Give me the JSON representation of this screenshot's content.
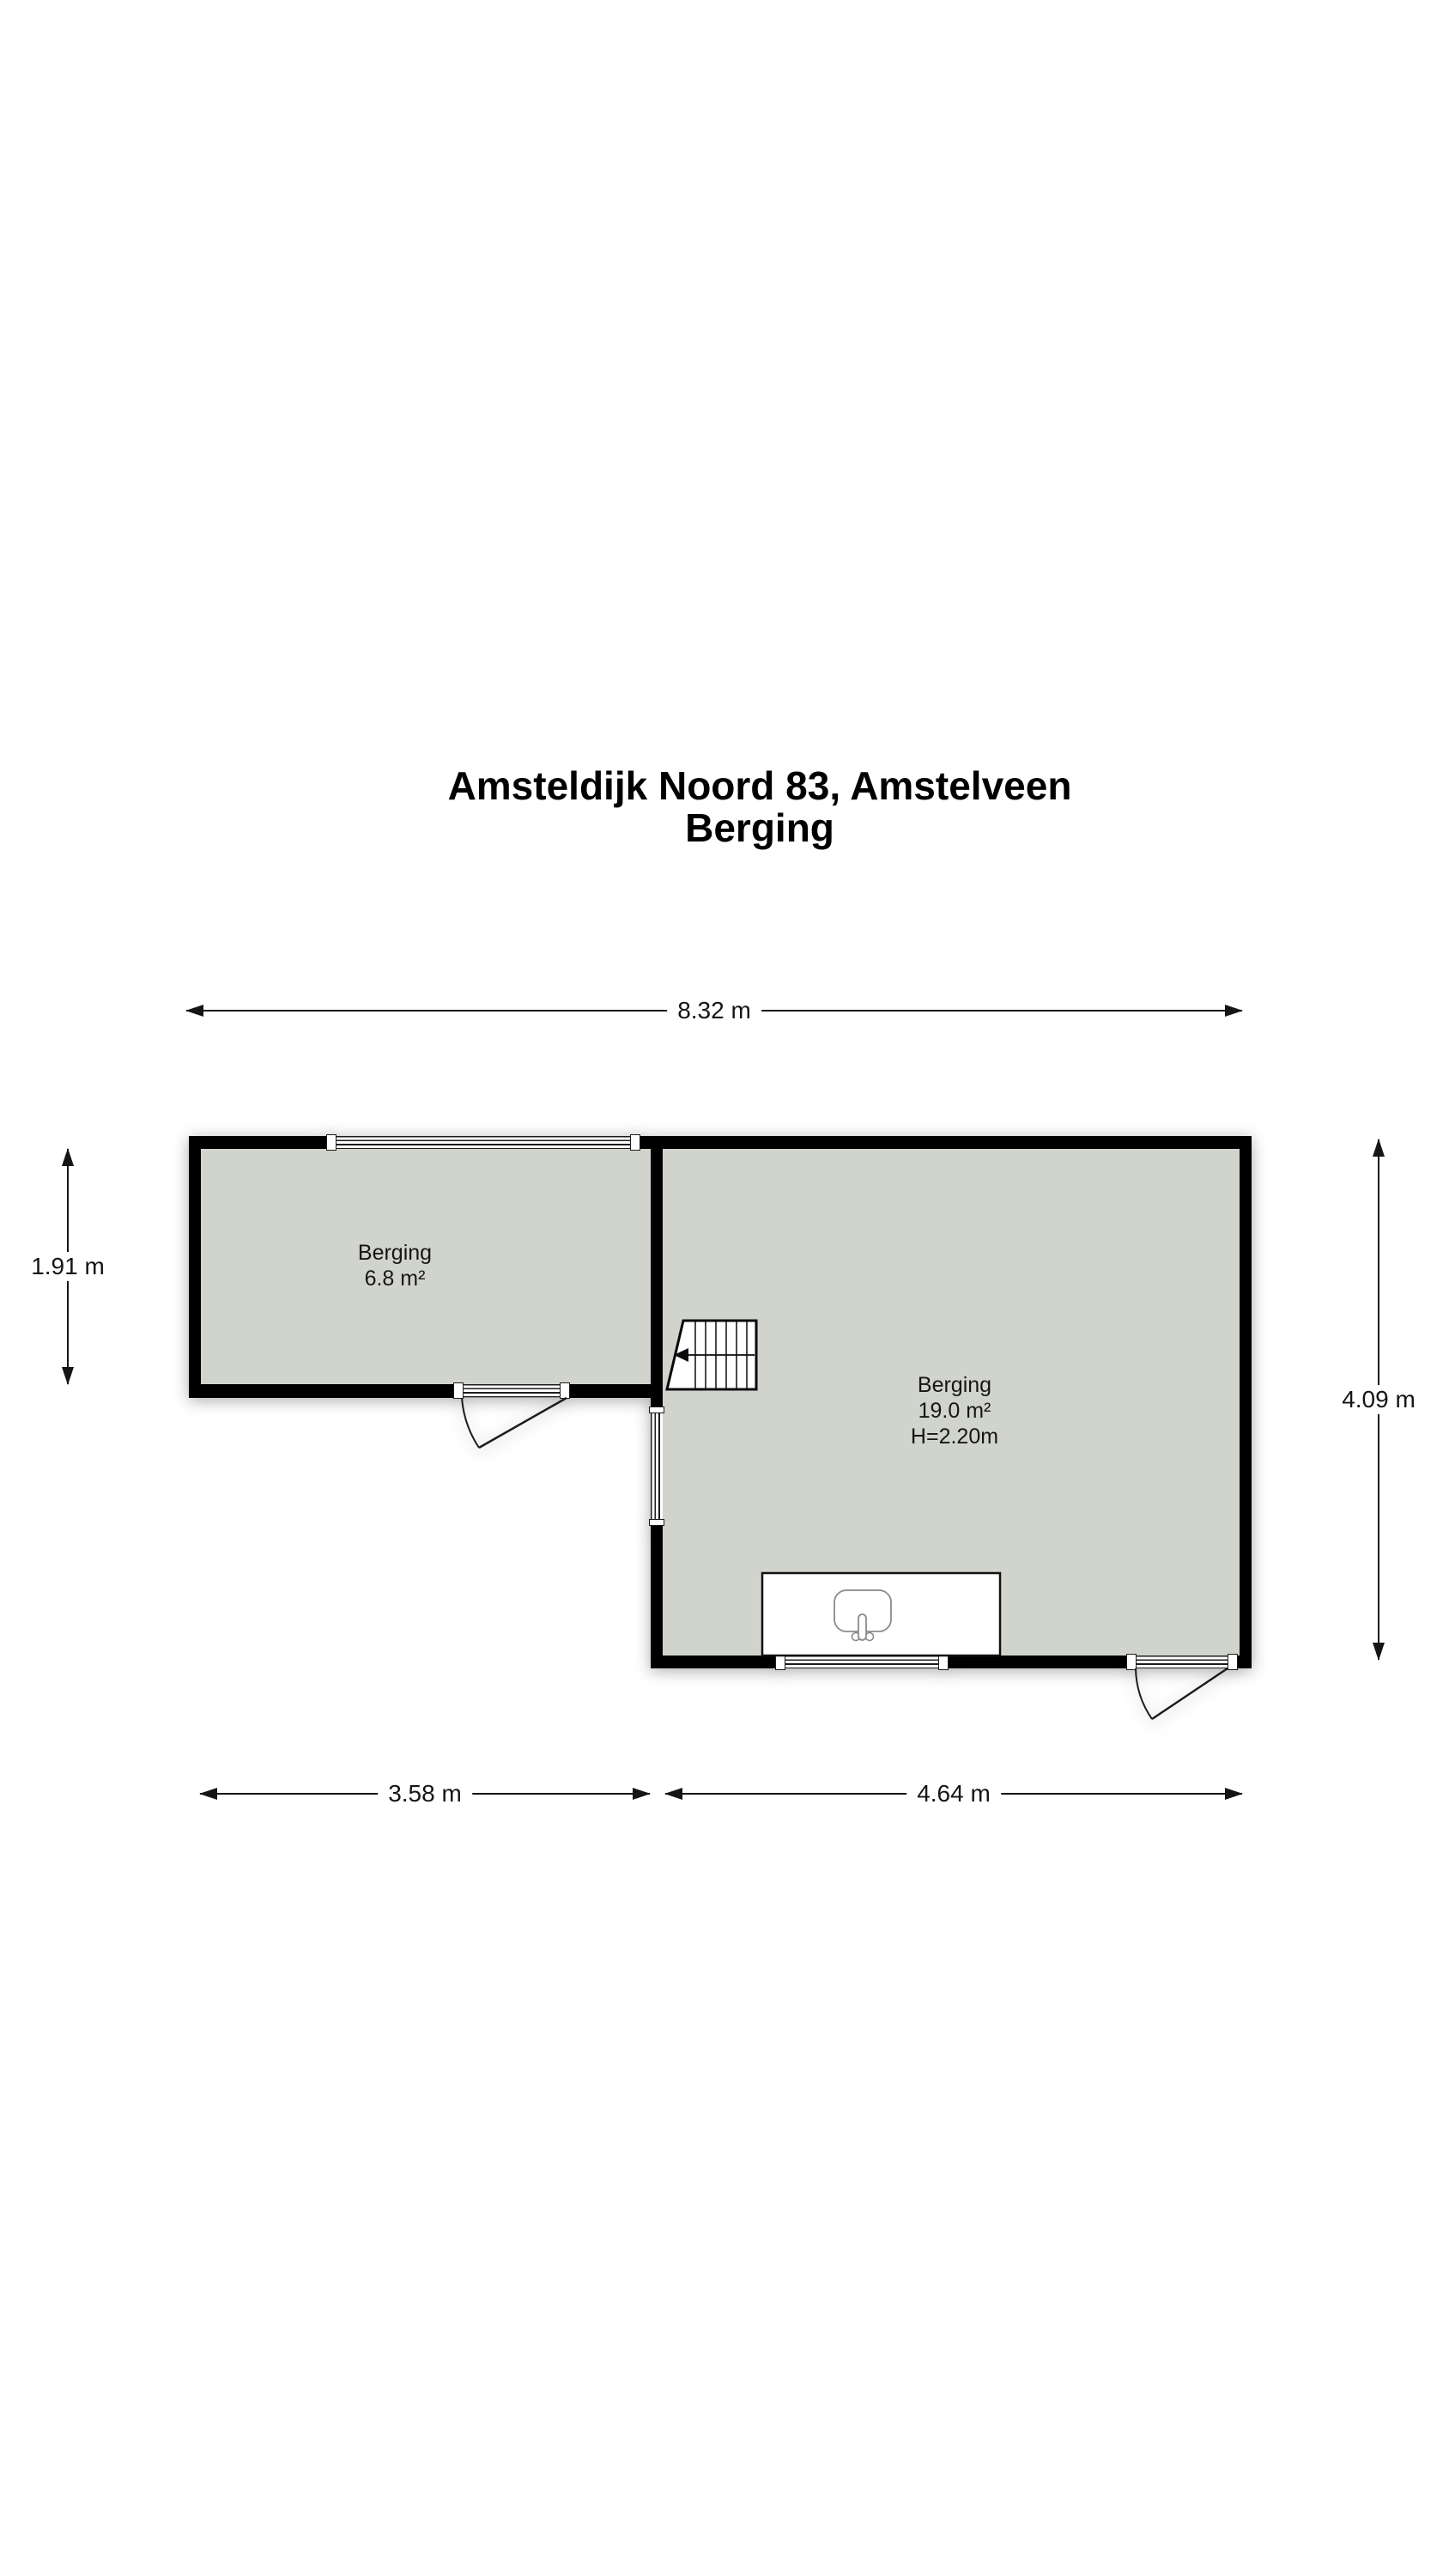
{
  "title": {
    "line1": "Amsteldijk Noord 83, Amstelveen",
    "line2": "Berging"
  },
  "rooms": [
    {
      "name": "Berging",
      "area": "6.8 m²"
    },
    {
      "name": "Berging",
      "area": "19.0 m²",
      "ceiling_height": "H=2.20m"
    }
  ],
  "dimensions": {
    "total_width": "8.32 m",
    "left_height": "1.91 m",
    "right_height": "4.09 m",
    "bottom_left_width": "3.58 m",
    "bottom_right_width": "4.64 m"
  },
  "colors": {
    "wall": "#000000",
    "floor": "#d1d4cc",
    "dimension_line": "#151515",
    "text": "#161616"
  }
}
